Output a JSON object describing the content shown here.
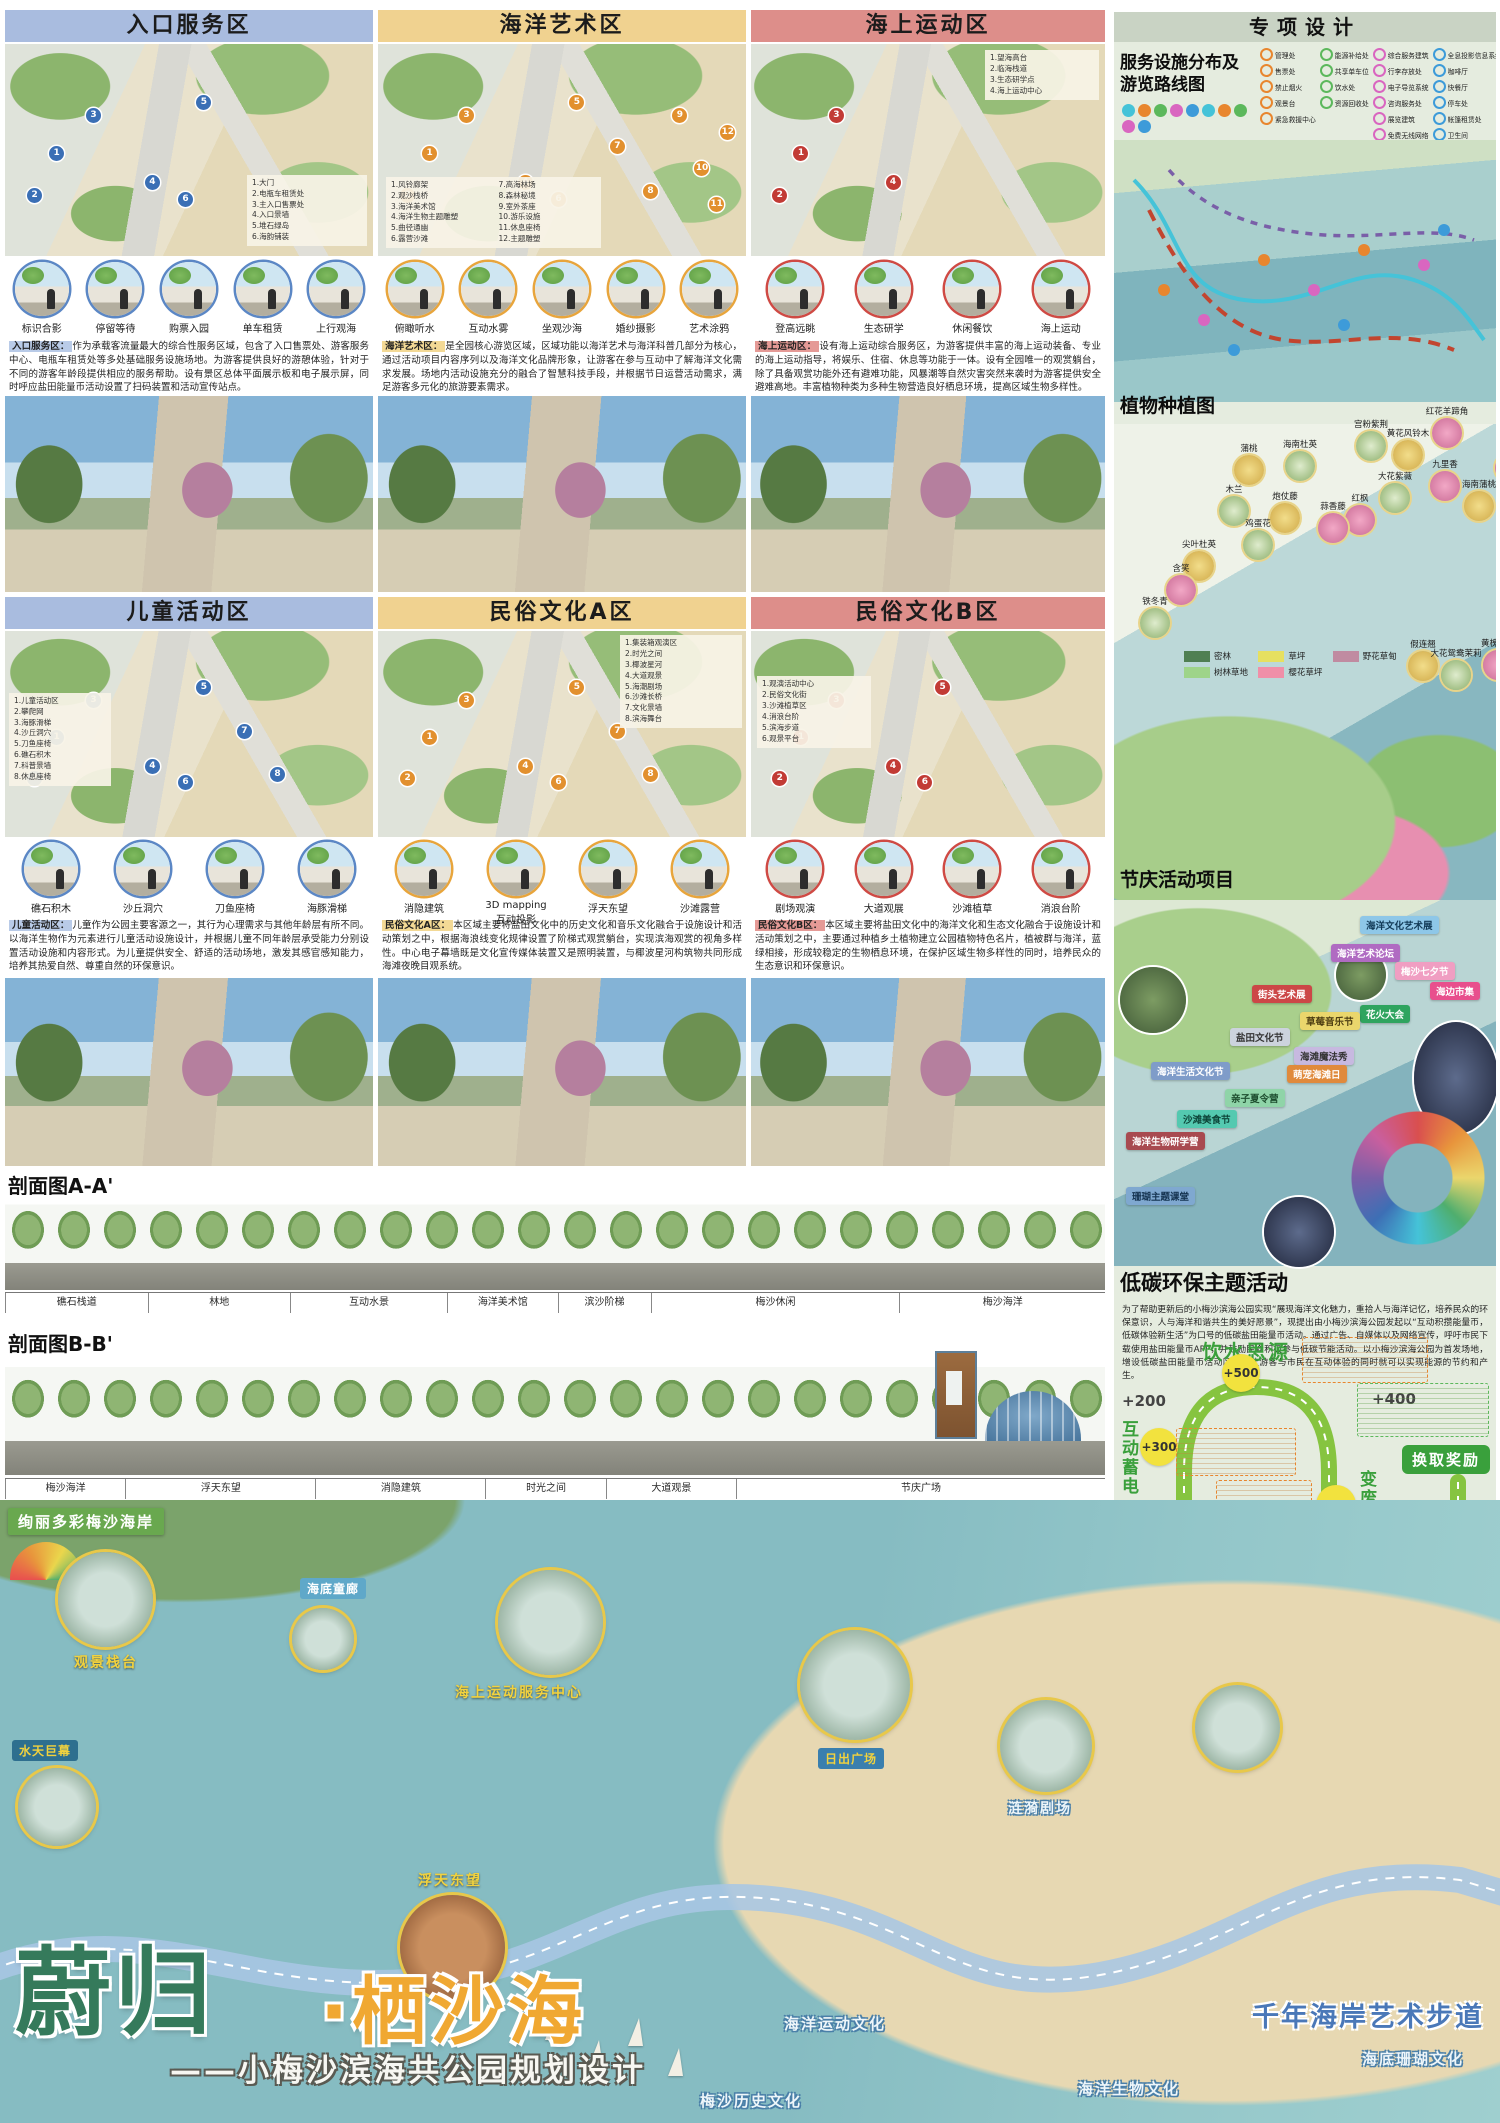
{
  "zones": [
    {
      "title": "入口服务区",
      "legend": [
        "1.大门",
        "2.电瓶车租赁处",
        "3.主入口售票处",
        "4.入口景墙",
        "5.堆石绿岛",
        "6.海韵铺装"
      ],
      "icons": [
        "标识合影",
        "停留等待",
        "购票入园",
        "单车租赁",
        "上行观海"
      ],
      "desc_tag": "入口服务区",
      "desc": "作为承载客流量最大的综合性服务区域，包含了入口售票处、游客服务中心、电瓶车租赁处等多处基础服务设施场地。为游客提供良好的游憩体验，针对于不同的游客年龄段提供相应的服务帮助。设有景区总体平面展示板和电子展示屏，同时呼应盐田能量币活动设置了扫码装置和活动宣传站点。"
    },
    {
      "title": "海洋艺术区",
      "legend": [
        "1.风铃廊架",
        "2.观沙栈桥",
        "3.海洋美术馆",
        "4.海洋生物主题雕塑",
        "5.曲径通幽",
        "6.露营沙滩",
        "7.高海林场",
        "8.森林秘境",
        "9.室外茶座",
        "10.游乐设施",
        "11.休息座椅",
        "12.主题雕塑"
      ],
      "icons": [
        "俯瞰听水",
        "互动水雾",
        "坐观沙海",
        "婚纱摄影",
        "艺术涂鸦"
      ],
      "desc_tag": "海洋艺术区",
      "desc": "是全园核心游览区域，区域功能以海洋艺术与海洋科普几部分为核心，通过活动项目内容序列以及海洋文化品牌形象，让游客在参与互动中了解海洋文化需求发展。场地内活动设施充分的融合了智慧科技手段，并根据节日运营活动需求，满足游客多元化的旅游要素需求。"
    },
    {
      "title": "海上运动区",
      "legend": [
        "1.望海高台",
        "2.临海栈道",
        "3.生态研学点",
        "4.海上运动中心"
      ],
      "icons": [
        "登高远眺",
        "生态研学",
        "休闲餐饮",
        "海上运动"
      ],
      "desc_tag": "海上运动区",
      "desc": "设有海上运动综合服务区，为游客提供丰富的海上运动装备、专业的海上运动指导，将娱乐、住宿、休息等功能于一体。设有全园唯一的观赏躺台，除了具备观赏功能外还有避难功能，风暴潮等自然灾害突然来袭时为游客提供安全避难高地。丰富植物种类为多种生物营造良好栖息环境，提高区域生物多样性。"
    },
    {
      "title": "儿童活动区",
      "legend": [
        "1.儿童活动区",
        "2.攀爬网",
        "3.海豚滑梯",
        "4.沙丘洞穴",
        "5.刀鱼座椅",
        "6.礁石积木",
        "7.科普景墙",
        "8.休息座椅"
      ],
      "icons": [
        "礁石积木",
        "沙丘洞穴",
        "刀鱼座椅",
        "海豚滑梯"
      ],
      "desc_tag": "儿童活动区",
      "desc": "儿童作为公园主要客源之一，其行为心理需求与其他年龄层有所不同。以海洋生物作为元素进行儿童活动设施设计，并根据儿童不同年龄层承受能力分别设置活动设施和内容形式。为儿童提供安全、舒适的活动场地，激发其感官感知能力，培养其热爱自然、尊重自然的环保意识。"
    },
    {
      "title": "民俗文化A区",
      "legend": [
        "1.集装箱观演区",
        "2.时光之间",
        "3.椰波星河",
        "4.大道观景",
        "5.海潮剧场",
        "6.沙滩长桥",
        "7.文化景墙",
        "8.滨海舞台"
      ],
      "icons": [
        "消隐建筑",
        "3D mapping 互动投影",
        "浮天东望",
        "沙滩露营"
      ],
      "desc_tag": "民俗文化A区",
      "desc": "本区域主要将盐田文化中的历史文化和音乐文化融合于设施设计和活动策划之中，根据海浪线变化规律设置了阶梯式观赏躺台，实现滨海观赏的视角多样性。中心电子幕墙既是文化宣传媒体装置又是照明装置，与椰波星河构筑物共同形成海滩夜晚目观系统。"
    },
    {
      "title": "民俗文化B区",
      "legend": [
        "1.观演活动中心",
        "2.民俗文化街",
        "3.沙滩植草区",
        "4.消浪台阶",
        "5.滨海步道",
        "6.观景平台"
      ],
      "icons": [
        "剧场观演",
        "大道观展",
        "沙滩植草",
        "消浪台阶"
      ],
      "desc_tag": "民俗文化B区",
      "desc": "本区域主要将盐田文化中的海洋文化和生态文化融合于设施设计和活动策划之中，主要通过种植乡土植物建立公园植物特色名片，植被群与海洋，蓝绿相接，形成较稳定的生物栖息环境，在保护区域生物多样性的同时，培养民众的生态意识和环保意识。"
    }
  ],
  "sections": {
    "aa_label": "剖面图A-A'",
    "aa_strip": [
      "礁石栈道",
      "林地",
      "互动水景",
      "海洋美术馆",
      "滨沙阶梯",
      "梅沙休闲",
      "梅沙海洋"
    ],
    "bb_label": "剖面图B-B'",
    "bb_strip": [
      "梅沙海洋",
      "浮天东望",
      "消隐建筑",
      "时光之间",
      "大道观景",
      "节庆广场"
    ]
  },
  "special": {
    "header": "专项设计",
    "service_title_1": "服务设施分布及",
    "service_title_2": "游览路线图",
    "fac1": [
      "管理处",
      "售票处",
      "禁止烟火",
      "观景台",
      "紧急救援中心"
    ],
    "fac2": [
      "能源补给处",
      "共享单车位",
      "饮水处",
      "资源回收处"
    ],
    "fac3": [
      "综合服务建筑",
      "行李存放处",
      "电子导览系统",
      "咨询服务处",
      "展览建筑",
      "免费无线网络"
    ],
    "fac4": [
      "全息投影信息系统",
      "咖啡厅",
      "快餐厅",
      "停车处",
      "帐篷租赁处",
      "卫生间"
    ],
    "routes": [
      {
        "label": "互动体验径",
        "color": "#45c3d8",
        "style": "solid"
      },
      {
        "label": "探索感知径",
        "color": "#c2452f",
        "style": "dashed"
      },
      {
        "label": "科普文化径",
        "color": "#7a5fa8",
        "style": "dashed"
      }
    ],
    "planting_title": "植物种植图",
    "plants": [
      "红花羊蹄角",
      "宫粉紫荆",
      "黄花风铃木",
      "榕树",
      "海南杜英",
      "蒲桃",
      "九里香",
      "大花紫薇",
      "海南蒲桃",
      "红枫",
      "木兰",
      "炮仗藤",
      "蒜香藤",
      "鸡蛋花",
      "尖叶杜英",
      "含笑",
      "铁冬青",
      "假连翘",
      "黄槐决明",
      "大花鸳鸯茉莉"
    ],
    "plant_legend": [
      {
        "label": "密林",
        "color": "#4f7f52"
      },
      {
        "label": "草坪",
        "color": "#e6e060"
      },
      {
        "label": "野花草甸",
        "color": "#c08ba1"
      },
      {
        "label": "树林草地",
        "color": "#9ed489"
      },
      {
        "label": "樱花草坪",
        "color": "#f08fa8"
      }
    ],
    "festival_title": "节庆活动项目",
    "festivals": [
      {
        "label": "海洋文化艺术展",
        "bg": "#8ec7e8",
        "fg": "#123a57"
      },
      {
        "label": "海洋艺术论坛",
        "bg": "#b06bc2",
        "fg": "#ffffff"
      },
      {
        "label": "梅沙七夕节",
        "bg": "#f09ec2",
        "fg": "#ffffff"
      },
      {
        "label": "街头艺术展",
        "bg": "#cc4747",
        "fg": "#ffffff"
      },
      {
        "label": "海边市集",
        "bg": "#e84f8d",
        "fg": "#ffffff"
      },
      {
        "label": "花火大会",
        "bg": "#2fa45f",
        "fg": "#ffffff"
      },
      {
        "label": "草莓音乐节",
        "bg": "#ead66c",
        "fg": "#4a3b10"
      },
      {
        "label": "盐田文化节",
        "bg": "#ccd3dd",
        "fg": "#333333"
      },
      {
        "label": "海滩魔法秀",
        "bg": "#c7b9e0",
        "fg": "#333333"
      },
      {
        "label": "海洋生活文化节",
        "bg": "#7f9cc9",
        "fg": "#ffffff"
      },
      {
        "label": "萌宠海滩日",
        "bg": "#e08a3c",
        "fg": "#ffffff"
      },
      {
        "label": "亲子夏令营",
        "bg": "#8fd4a8",
        "fg": "#1d4d2e"
      },
      {
        "label": "沙滩美食节",
        "bg": "#54c9b0",
        "fg": "#0d4438"
      },
      {
        "label": "海洋生物研学营",
        "bg": "#a84a50",
        "fg": "#ffffff"
      },
      {
        "label": "珊瑚主题课堂",
        "bg": "#7fa8d0",
        "fg": "#14324f"
      }
    ],
    "lowcarbon_title": "低碳环保主题活动",
    "lowcarbon_intro": "为了帮助更新后的小梅沙滨海公园实现“展现海洋文化魅力，重拾人与海洋记忆，培养民众的环保意识，人与海洋和谐共生的美好愿景”，现提出由小梅沙滨海公园发起以“互动积攒能量币，低碳体验新生活”为口号的低碳盐田能量币活动。通过广告、自媒体以及网络宣传，呼吁市民下载使用盐田能量币APP，并鼓励民众积极参与低碳节能活动。以小梅沙滨海公园为首发场地，增设低碳盐田能量币活动区域，让游客与市民在互动体验的同时就可以实现能源的节约和产生。",
    "values": {
      "v500": "+500",
      "v400": "+400",
      "v200a": "+200",
      "v300": "+300",
      "v900": "+900",
      "v200b": "+200",
      "v100": "+100",
      "v2000": "+2000",
      "v1500": "+1500"
    },
    "stations": {
      "s1": "饮水思源",
      "s2": "互动蓄电",
      "s3": "绿色出行",
      "s4": "变废为宝",
      "s5": "换取奖励",
      "s6": "人海共栖",
      "s7": "沉浸节能",
      "s8": "互动体验"
    }
  },
  "bottom": {
    "area_tag": "绚丽多彩梅沙海岸",
    "callouts": {
      "c1": "观景栈台",
      "c2": "水天巨幕",
      "c3": "海底童廊",
      "c4": "海上运动服务中心",
      "c5": "日出广场",
      "c6": "浮天东望",
      "c7": "涟漪剧场"
    },
    "title_green": "蔚归",
    "title_orange": "·栖沙海",
    "subtitle": "——小梅沙滨海共公园规划设计",
    "cultures": {
      "h1": "梅沙历史文化",
      "h2": "海洋运动文化",
      "h3": "海洋生物文化",
      "h4": "海底珊瑚文化"
    },
    "walkway": "千年海岸艺术步道"
  }
}
